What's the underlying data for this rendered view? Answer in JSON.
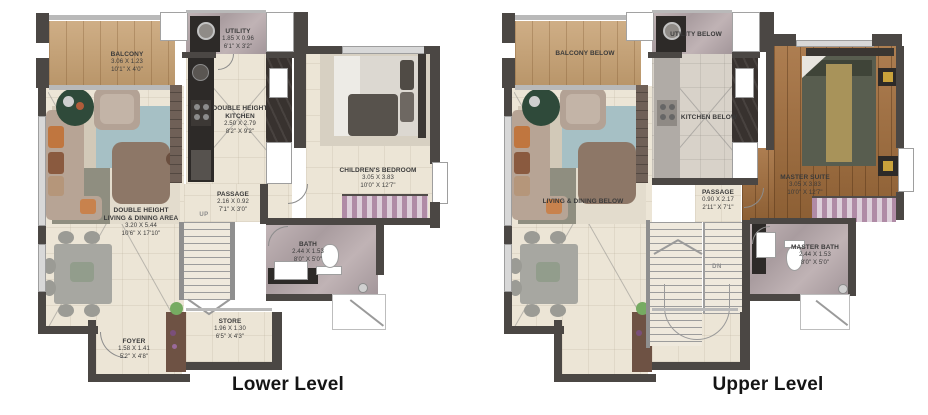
{
  "colors": {
    "wall_dark": "#4b4744",
    "wall_light": "#b9b9b9",
    "floor_cream": "#ece5d6",
    "floor_wood_balcony": "#c7a172",
    "floor_wood_master": "#a46f3d",
    "floor_marble": "#b3a6a8",
    "counter_dark": "#2d2a28",
    "wardrobe_stripe": "#b08ba6",
    "plant_green": "#76ab62",
    "label_text": "#3a3a3a"
  },
  "lower": {
    "caption": "Lower Level",
    "stair_label": "UP",
    "rooms": {
      "balcony": {
        "name": "BALCONY",
        "metric": "3.06 X 1.23",
        "imperial": "10'1\" X 4'0\""
      },
      "utility": {
        "name": "UTILITY",
        "metric": "1.85 X 0.96",
        "imperial": "6'1\" X 3'2\""
      },
      "kitchen": {
        "name": "DOUBLE HEIGHT",
        "name2": "KITCHEN",
        "metric": "2.50 X 2.79",
        "imperial": "8'2\" X 9'2\""
      },
      "children": {
        "name": "CHILDREN'S BEDROOM",
        "metric": "3.05 X 3.83",
        "imperial": "10'0\" X 12'7\""
      },
      "passage": {
        "name": "PASSAGE",
        "metric": "2.16 X 0.92",
        "imperial": "7'1\" X 3'0\""
      },
      "living": {
        "name": "DOUBLE HEIGHT",
        "name2": "LIVING & DINING AREA",
        "metric": "3.20 X 5.44",
        "imperial": "10'6\" X 17'10\""
      },
      "bath": {
        "name": "BATH",
        "metric": "2.44 X 1.53",
        "imperial": "8'0\" X 5'0\""
      },
      "store": {
        "name": "STORE",
        "metric": "1.96 X 1.30",
        "imperial": "6'5\" X 4'3\""
      },
      "foyer": {
        "name": "FOYER",
        "metric": "1.58 X 1.41",
        "imperial": "5'2\" X 4'8\""
      }
    }
  },
  "upper": {
    "caption": "Upper Level",
    "stair_label": "DN",
    "rooms": {
      "balcony_below": {
        "name": "BALCONY BELOW"
      },
      "utility_below": {
        "name": "UTILITY BELOW"
      },
      "kitchen_below": {
        "name": "KITCHEN BELOW"
      },
      "master_suite": {
        "name": "MASTER SUITE",
        "metric": "3.05 X 3.83",
        "imperial": "10'0\" X 12'7\""
      },
      "passage": {
        "name": "PASSAGE",
        "metric": "0.90 X 2.17",
        "imperial": "2'11\" X 7'1\""
      },
      "living_below": {
        "name": "LIVING & DINING BELOW"
      },
      "master_bath": {
        "name": "MASTER BATH",
        "metric": "2.44 X 1.53",
        "imperial": "8'0\" X 5'0\""
      }
    }
  }
}
